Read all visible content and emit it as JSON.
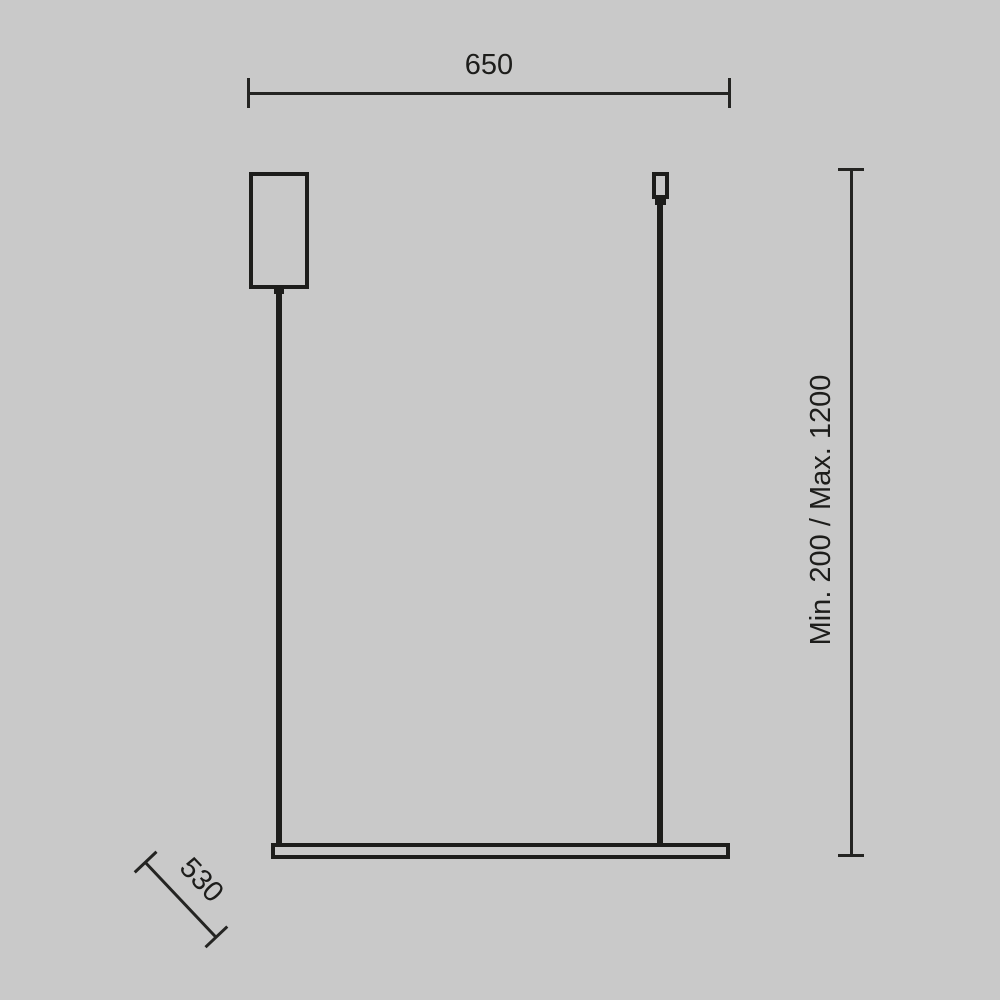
{
  "page": {
    "background_color": "#c9c9c9",
    "line_color": "#1d1d1b"
  },
  "diagram": {
    "type": "technical-dimension-drawing",
    "dimensions": {
      "width": {
        "label": "650"
      },
      "height": {
        "label": "Min. 200 / Max. 1200"
      },
      "length": {
        "label": "530"
      }
    }
  }
}
